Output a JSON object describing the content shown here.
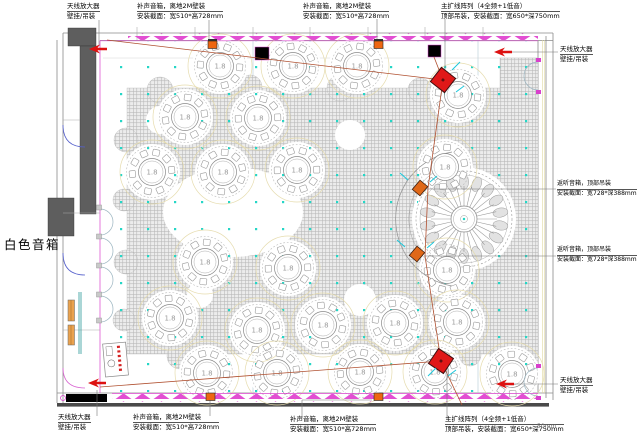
{
  "side_label": "白色音箱",
  "scale_note": "50mm",
  "labels": {
    "antenna": {
      "l1": "天线放大器",
      "l2": "壁挂/吊装"
    },
    "fill": {
      "l1": "补声音箱，离地2M壁装",
      "l2": "安装截面：宽510*高728mm"
    },
    "main_array": {
      "l1": "主扩线阵列（4全频+1低音）",
      "l2": "顶部吊装，安装截面：宽650*深750mm"
    },
    "monitor": {
      "l1": "返听音箱，顶部吊装",
      "l2": "安装截面：宽728*深388mm"
    }
  },
  "floor": {
    "table_label": "1.8",
    "tables": [
      [
        220,
        66
      ],
      [
        293,
        66
      ],
      [
        357,
        66
      ],
      [
        458,
        95
      ],
      [
        185,
        117
      ],
      [
        258,
        118
      ],
      [
        445,
        167
      ],
      [
        152,
        172
      ],
      [
        223,
        172
      ],
      [
        297,
        170
      ],
      [
        205,
        262
      ],
      [
        288,
        268
      ],
      [
        447,
        270
      ],
      [
        170,
        318
      ],
      [
        257,
        330
      ],
      [
        323,
        325
      ],
      [
        395,
        323
      ],
      [
        457,
        322
      ],
      [
        207,
        373
      ],
      [
        277,
        373
      ],
      [
        360,
        372
      ],
      [
        435,
        372
      ],
      [
        512,
        374
      ]
    ]
  },
  "colors": {
    "accent_magenta": "#d840cc",
    "speaker_red": "#e01818",
    "monitor_orange": "#e06818",
    "wall_speaker_orange": "#ee6611",
    "arrow_red": "#dd1111",
    "cable_brown": "#b05030",
    "ceiling_dot_cyan": "#25d6c6",
    "carpet_gray": "#b6b6b6"
  }
}
